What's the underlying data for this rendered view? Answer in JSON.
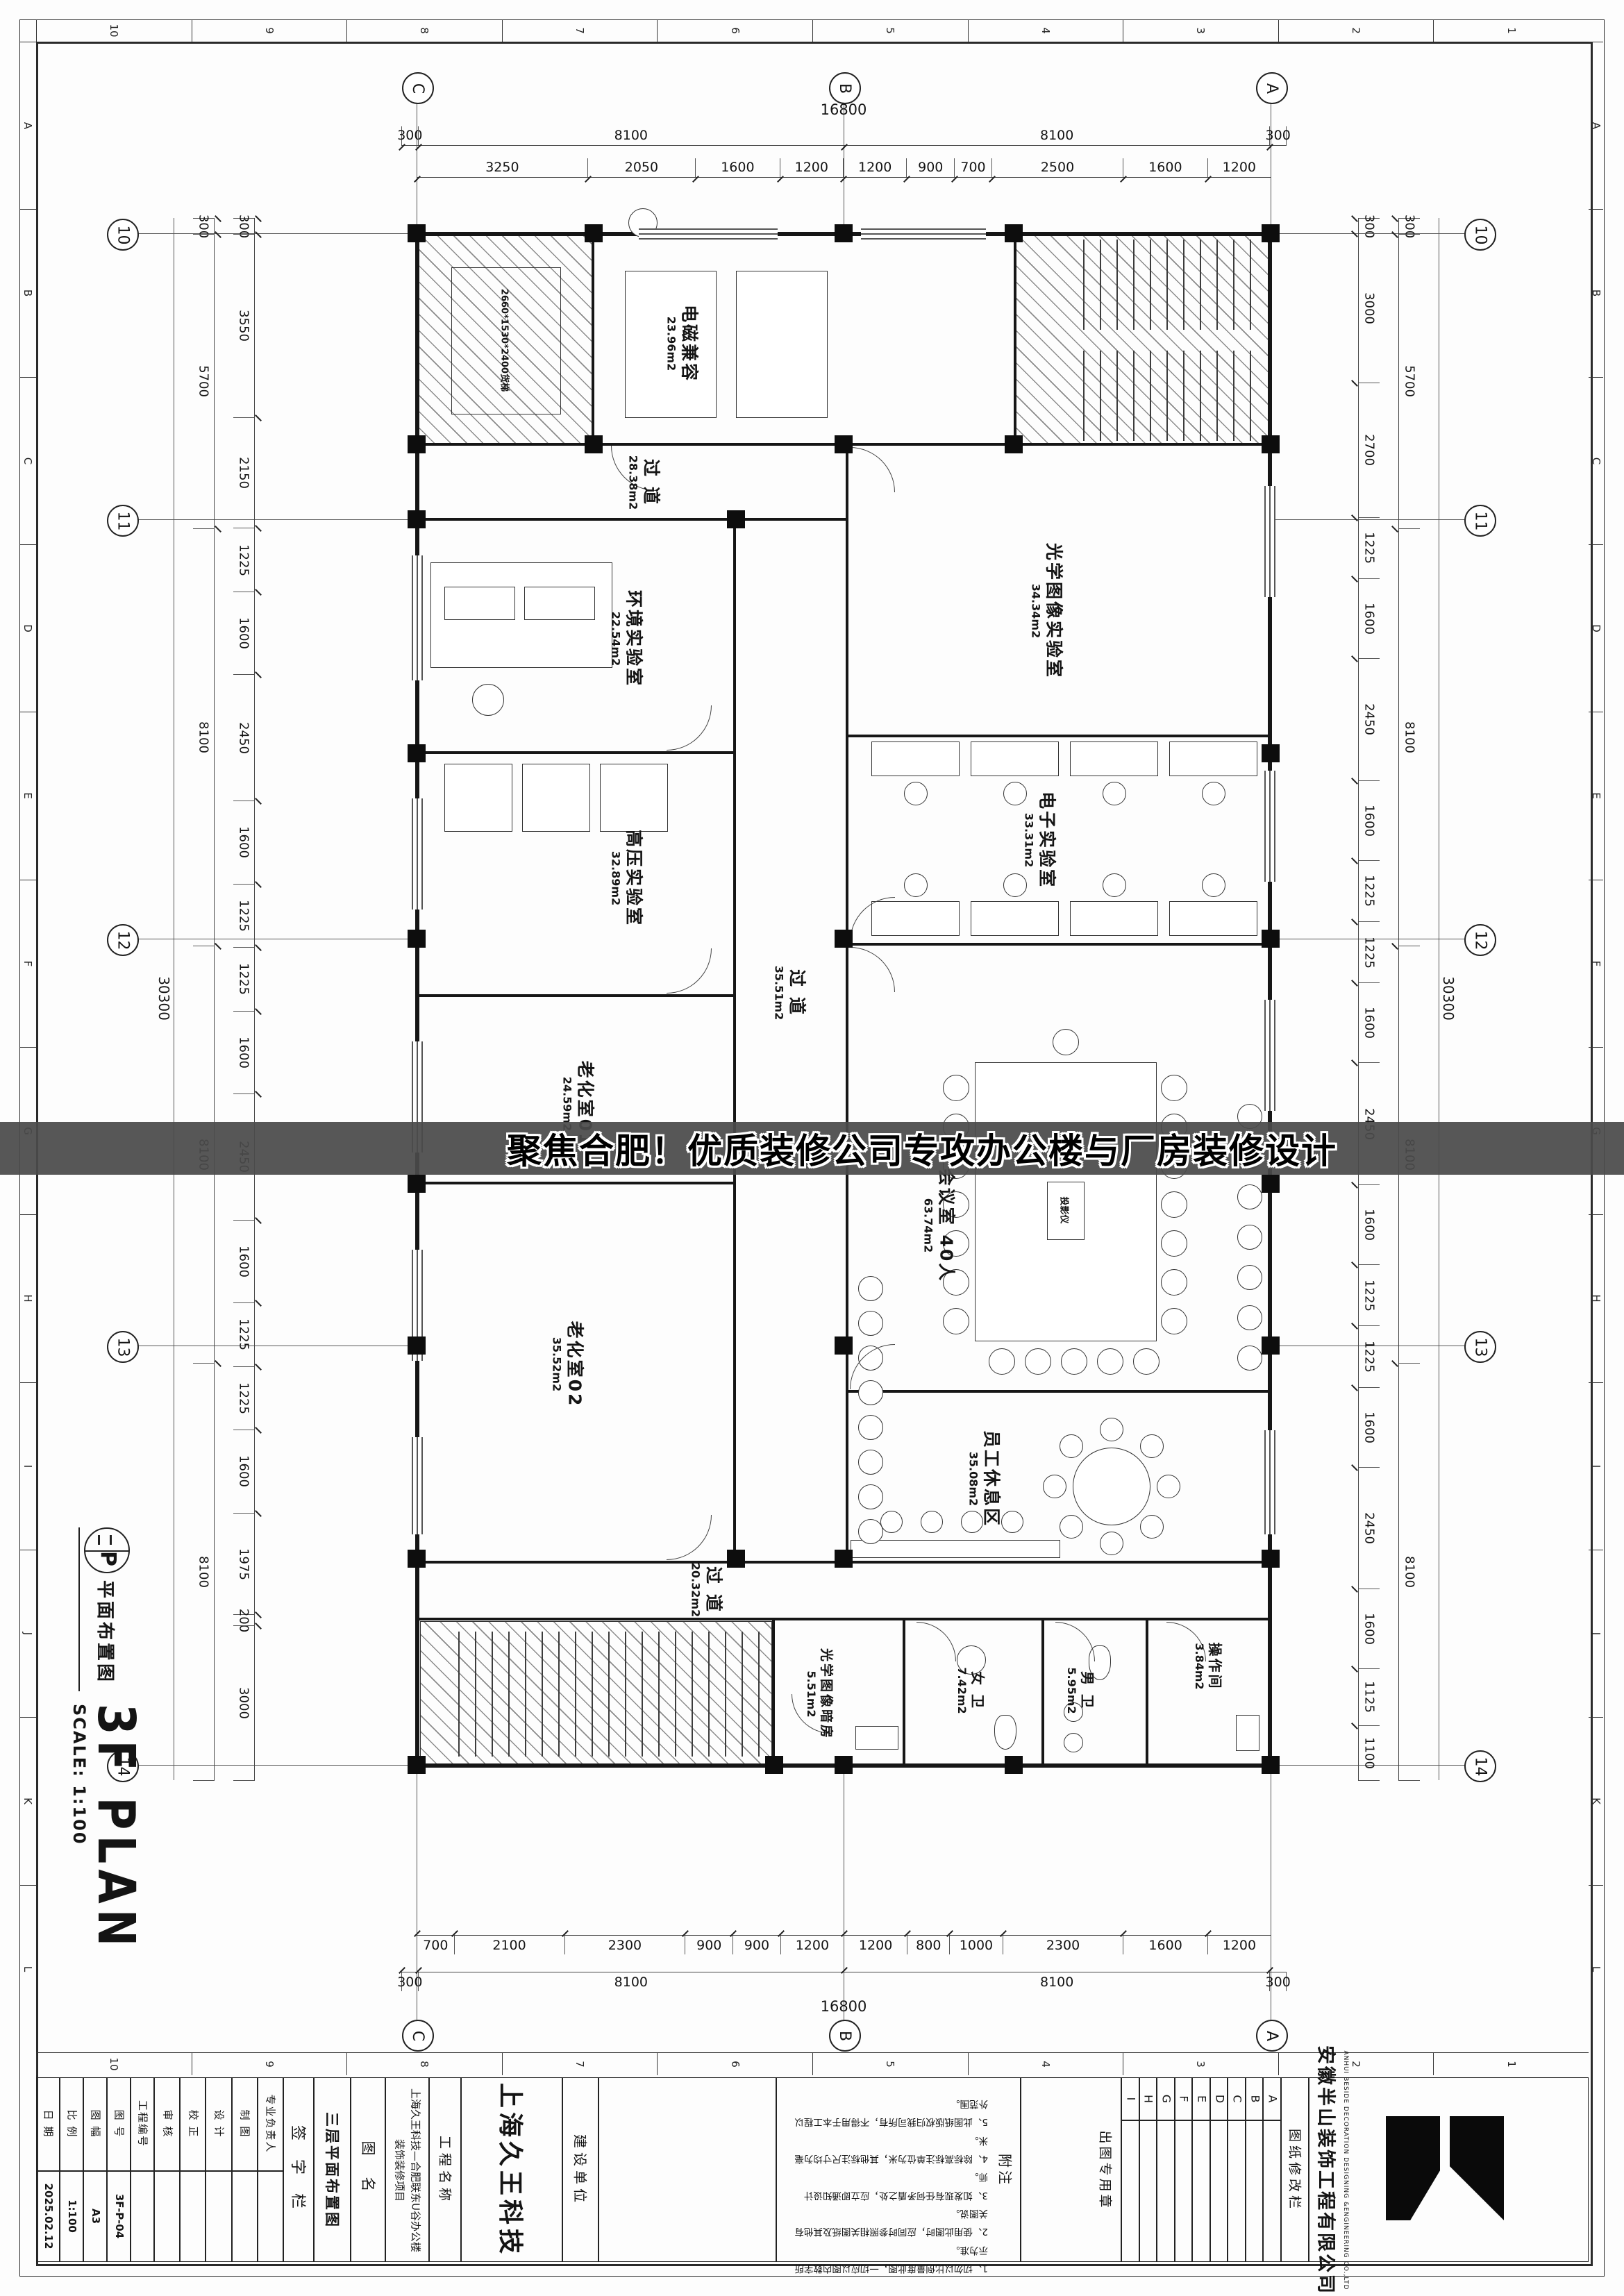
{
  "banner": {
    "text": "聚焦合肥！优质装修公司专攻办公楼与厂房装修设计"
  },
  "plan_title": {
    "symbol_letter": "P",
    "symbol_label": "平面布置图",
    "title": "3F PLAN",
    "scale": "SCALE: 1:100"
  },
  "grid": {
    "cols": [
      "C",
      "B",
      "A"
    ],
    "rows": [
      "10",
      "11",
      "12",
      "13",
      "14"
    ]
  },
  "ruler": {
    "numbers": [
      "10",
      "9",
      "8",
      "7",
      "6",
      "5",
      "4",
      "3",
      "2",
      "1"
    ],
    "letters": [
      "A",
      "B",
      "C",
      "D",
      "E",
      "F",
      "G",
      "H",
      "I",
      "J",
      "K",
      "L"
    ]
  },
  "dimensions": {
    "top_overall": "16800",
    "top_row1": [
      "300",
      "8100",
      "8100",
      "300"
    ],
    "top_row2": [
      "3250",
      "2050",
      "1600",
      "1200",
      "1200",
      "900",
      "700",
      "2500",
      "1600",
      "1200"
    ],
    "bottom_row2": [
      "700",
      "2100",
      "2300",
      "900",
      "900",
      "1200",
      "1200",
      "800",
      "1000",
      "2300",
      "1600",
      "1200"
    ],
    "bottom_row1": [
      "300",
      "8100",
      "8100",
      "300"
    ],
    "bottom_overall": "16800",
    "left_overall": "30300",
    "left_sections": [
      "300",
      "5700",
      "8100",
      "8100",
      "8100"
    ],
    "left_inner": [
      "300",
      "3550",
      "2150",
      "1225",
      "1600",
      "2450",
      "1600",
      "1225",
      "1225",
      "1600",
      "2450",
      "1600",
      "1225",
      "1225",
      "1600",
      "1975",
      "200",
      "3000"
    ],
    "right_overall": "30300",
    "right_sections": [
      "300",
      "5700",
      "8100",
      "8100",
      "8100"
    ],
    "right_inner": [
      "300",
      "3000",
      "2700",
      "1225",
      "1600",
      "2450",
      "1600",
      "1225",
      "1225",
      "1600",
      "2450",
      "1600",
      "1225",
      "1225",
      "1600",
      "2450",
      "1600",
      "1125",
      "1100"
    ]
  },
  "rooms": [
    {
      "name": "电磁兼容",
      "area": "23.96m2"
    },
    {
      "name": "过 道",
      "area": "28.38m2"
    },
    {
      "name": "环境实验室",
      "area": "22.54m2"
    },
    {
      "name": "高压实验室",
      "area": "32.89m2"
    },
    {
      "name": "老化室01",
      "area": "24.59m2"
    },
    {
      "name": "老化室02",
      "area": "35.52m2"
    },
    {
      "name": "过 道",
      "area": "35.51m2"
    },
    {
      "name": "光学图像实验室",
      "area": "34.34m2"
    },
    {
      "name": "电子实验室",
      "area": "33.31m2"
    },
    {
      "name": "会议室 40人",
      "area": "63.74m2"
    },
    {
      "name": "员工休息区",
      "area": "35.08m2"
    },
    {
      "name": "过 道",
      "area": "20.32m2"
    },
    {
      "name": "光学图像暗房",
      "area": "5.51m2"
    },
    {
      "name": "女 卫",
      "area": "7.42m2"
    },
    {
      "name": "男 卫",
      "area": "5.95m2"
    },
    {
      "name": "操作间",
      "area": "3.84m2"
    }
  ],
  "plan_labels": {
    "elevator": "2660*1530*2400货梯",
    "projector": "投影仪"
  },
  "title_block": {
    "fields": [
      {
        "label": "日 期",
        "value": "2025.02.12"
      },
      {
        "label": "比 例",
        "value": "1:100"
      },
      {
        "label": "图 幅",
        "value": "A3"
      },
      {
        "label": "图 号",
        "value": "3F-P-04"
      },
      {
        "label": "工程编号",
        "value": ""
      }
    ],
    "signatures": [
      "审 核",
      "校 正",
      "设 计",
      "制 图",
      "专业负责人"
    ],
    "sign_column": "签 字 栏",
    "drawing_name": "三层平面布置图",
    "drawing_name_label": "图 名",
    "project_name": "上海久王科技—合肥联东U谷办公楼装饰装修项目",
    "project_label": "工程名称",
    "client_name": "上海久王科技",
    "client_label": "建设单位",
    "notes_label": "附注",
    "notes": [
      "1、切勿以比例量度此图，一切应以图内数字所示为准。",
      "2、使用此图时，应同时参照相关图纸及其他有关图说。",
      "3、如发现有任何矛盾之处，应立即通知设计师。",
      "4、除标高标注单位为米，其他标注尺寸均为毫米。",
      "5、此图纸版权归我司所有，不得用于本工程以外范围。"
    ],
    "stamp_label": "出图专用章",
    "revision_rows": [
      "A",
      "B",
      "C",
      "D",
      "E",
      "F",
      "G",
      "H",
      "I"
    ],
    "revision_label": "图纸修改栏",
    "company_cn": "安徽半山装饰工程有限公司",
    "company_en": "ANHUI BESIDE DECORATION DESIGNING &ENGINEERING CO.,LTD"
  }
}
